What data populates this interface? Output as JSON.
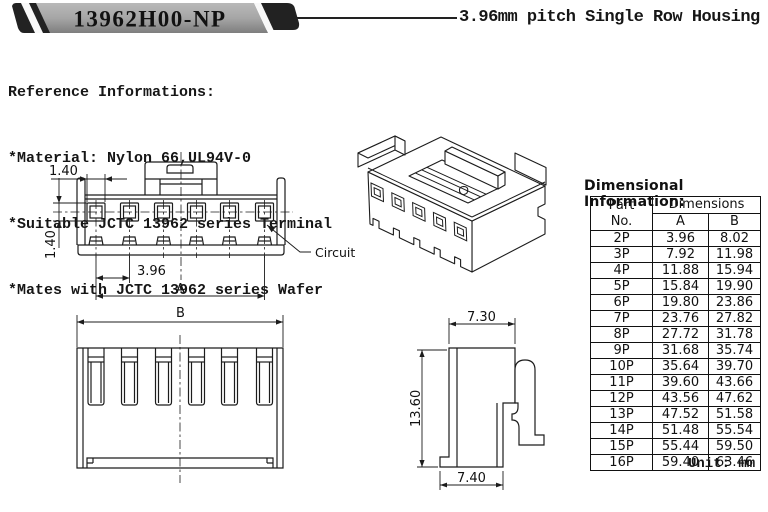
{
  "banner": {
    "part_number": "13962H00-NP",
    "subtitle": "3.96mm pitch Single Row Housing"
  },
  "reference": {
    "title": "Reference Informations:",
    "lines": [
      "*Material: Nylon 66,UL94V-0",
      "*Suitable JCTC 13962 series Terminal",
      "*Mates with JCTC 13962 series Wafer"
    ]
  },
  "front_view": {
    "dim_hole_width": "1.40",
    "dim_hole_height": "1.40",
    "dim_pitch": "3.96",
    "dim_span_label": "A",
    "circuit_callout": "Circuit 1"
  },
  "bottom_view": {
    "dim_span_label": "B"
  },
  "side_view": {
    "dim_top": "7.30",
    "dim_height": "13.60",
    "dim_bottom": "7.40"
  },
  "dimension_table": {
    "title": "Dimensional Information:",
    "header": {
      "part": "Part",
      "part_no": "No.",
      "dimensions": "Dimensions",
      "col_a": "A",
      "col_b": "B"
    },
    "rows": [
      {
        "part": "2P",
        "a": "3.96",
        "b": "8.02"
      },
      {
        "part": "3P",
        "a": "7.92",
        "b": "11.98"
      },
      {
        "part": "4P",
        "a": "11.88",
        "b": "15.94"
      },
      {
        "part": "5P",
        "a": "15.84",
        "b": "19.90"
      },
      {
        "part": "6P",
        "a": "19.80",
        "b": "23.86"
      },
      {
        "part": "7P",
        "a": "23.76",
        "b": "27.82"
      },
      {
        "part": "8P",
        "a": "27.72",
        "b": "31.78"
      },
      {
        "part": "9P",
        "a": "31.68",
        "b": "35.74"
      },
      {
        "part": "10P",
        "a": "35.64",
        "b": "39.70"
      },
      {
        "part": "11P",
        "a": "39.60",
        "b": "43.66"
      },
      {
        "part": "12P",
        "a": "43.56",
        "b": "47.62"
      },
      {
        "part": "13P",
        "a": "47.52",
        "b": "51.58"
      },
      {
        "part": "14P",
        "a": "51.48",
        "b": "55.54"
      },
      {
        "part": "15P",
        "a": "55.44",
        "b": "59.50"
      },
      {
        "part": "16P",
        "a": "59.40",
        "b": "63.46"
      }
    ],
    "unit_note": "Unit: mm",
    "line_color": "#1c1c1c"
  }
}
